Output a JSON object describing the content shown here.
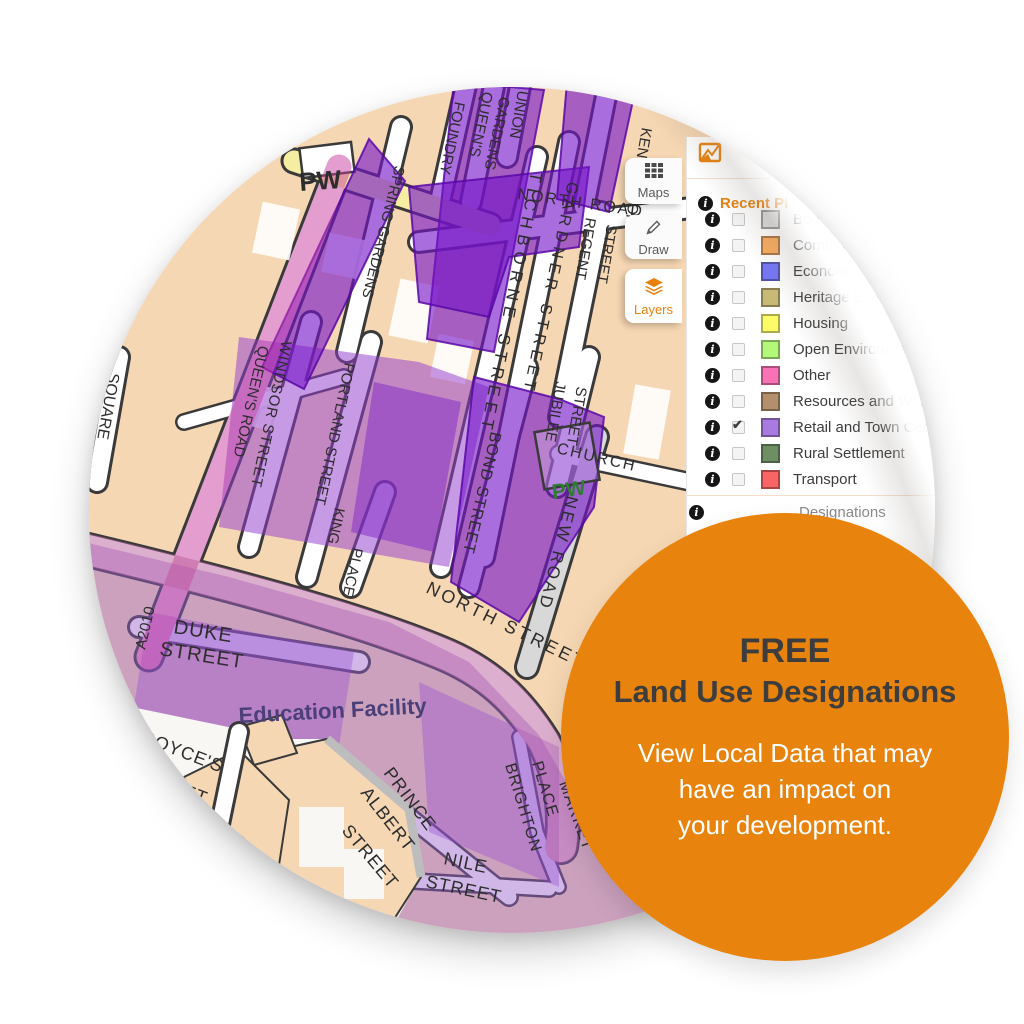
{
  "promo": {
    "line1": "FREE",
    "line2": "Land Use Designations",
    "body_lines": [
      "View Local Data that may",
      "have an impact on",
      "your development."
    ],
    "bg": "#E8830E",
    "headline_color": "#3D3D3D",
    "body_color": "#FFFFFF"
  },
  "toolbar": {
    "buttons": [
      {
        "label": "Maps",
        "icon": "grid-icon",
        "active": false
      },
      {
        "label": "Draw",
        "icon": "pencil-icon",
        "active": false
      },
      {
        "label": "Layers",
        "icon": "layers-icon",
        "active": true
      }
    ],
    "active_color": "#E8820E"
  },
  "layers_panel": {
    "header_icon": "site-plan-icon",
    "info_glyph": "i",
    "section_label": "Recent Pl",
    "section_color": "#E8820E",
    "footer_label": "Designations",
    "layers": [
      {
        "label": "Bou",
        "color": "#DCDCDC",
        "checked": false,
        "check": ""
      },
      {
        "label": "Commu",
        "color": "#FAAC5E",
        "checked": false,
        "check": ""
      },
      {
        "label": "Economy",
        "color": "#7576F5",
        "checked": false,
        "check": ""
      },
      {
        "label": "Heritage Envi",
        "color": "#C9B977",
        "checked": false,
        "check": ""
      },
      {
        "label": "Housing",
        "color": "#FCFC69",
        "checked": false,
        "check": ""
      },
      {
        "label": "Open Environmen",
        "color": "#B4F87A",
        "checked": false,
        "check": ""
      },
      {
        "label": "Other",
        "color": "#F972B5",
        "checked": false,
        "check": ""
      },
      {
        "label": "Resources and Waste",
        "color": "#B3906B",
        "checked": false,
        "check": ""
      },
      {
        "label": "Retail and Town Centre",
        "color": "#A97BE0",
        "checked": true,
        "check": "✔"
      },
      {
        "label": "Rural Settlement",
        "color": "#6E8E64",
        "checked": false,
        "check": ""
      },
      {
        "label": "Transport",
        "color": "#FB6464",
        "checked": false,
        "check": ""
      }
    ]
  },
  "map": {
    "street_labels": [
      "PW",
      "SPRING GARDENS",
      "FOUNDRY",
      "QUEEN'S",
      "GARDENS",
      "UNION",
      "KENSINGTON",
      "NORTH ROAD",
      "TICHBORNE STREET",
      "GARDNER STREET",
      "REGENT",
      "STREET",
      "JUBILEE",
      "STREET",
      "CHURCH",
      "NEW ROAD",
      "BOND STREET",
      "PW",
      "WINDSOR STREET",
      "PORTLAND STREET",
      "KING",
      "PLACE",
      "QUEEN'S ROAD",
      "SQUARE",
      "A2010",
      "DUKE",
      "STREET",
      "NORTH STREET",
      "Education Facility",
      "BOYCE'S",
      "STREET",
      "PRINCE",
      "ALBERT",
      "STREET",
      "NILE",
      "STREET",
      "BRIGHTON",
      "PLACE",
      "MARKET",
      "STREET"
    ],
    "colors": {
      "block": "#F6D7B3",
      "street": "#FFFFFF",
      "casing": "#3A3A3A",
      "yellow_road": "#F5EEA2",
      "grey_road": "#D8D8D8",
      "dark_purple": "rgba(116,20,200,0.62)",
      "dark_purple_stroke": "rgba(90,8,168,0.85)",
      "mid_purple": "rgba(148,62,206,0.52)",
      "deep_mid_purple": "rgba(128,38,200,0.5)",
      "mid_block": "rgba(150,70,210,0.35)",
      "lavender": "rgba(150,95,205,0.45)",
      "pink_road": "rgba(200,60,158,0.5)",
      "mauve_road": "rgba(188,95,158,0.5)",
      "label": "#2D2D2D",
      "pw_green": "#2F7D32",
      "facility_label": "#4A3F78"
    }
  }
}
